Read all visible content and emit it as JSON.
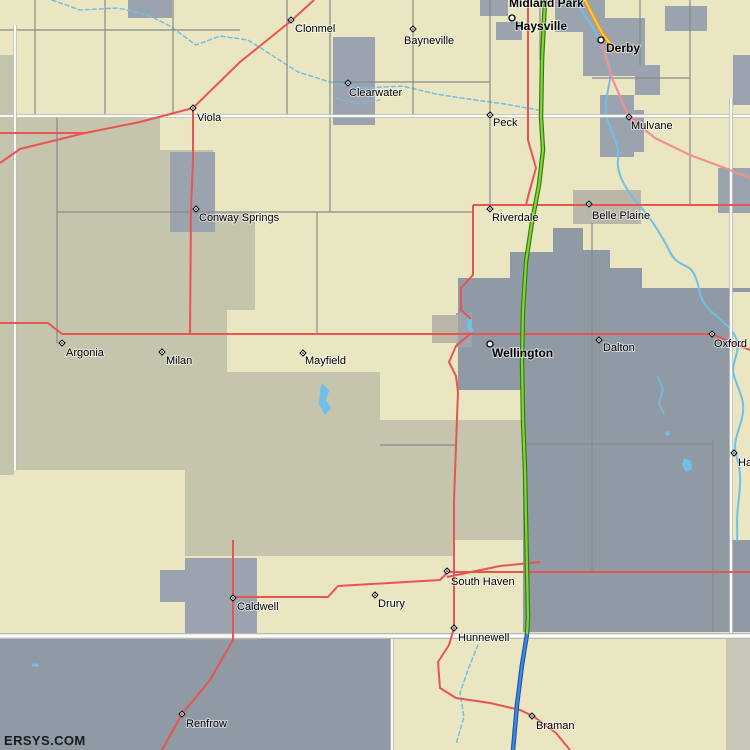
{
  "watermark": "ERSYS.COM",
  "map": {
    "width": 750,
    "height": 750,
    "palette": {
      "land_beige": "#e9e6c1",
      "land_sage": "#c5c4ac",
      "land_bluegray": "#8f9aa5",
      "urban_gray": "#9aa3ae",
      "urban_tan": "#bab7a9",
      "strip_gray": "#c9c8b8",
      "water": "#6fc0e8",
      "road_gray": "#8a8a8a",
      "road_white": "#f8f8f6",
      "road_white_casing": "#c0c0bb",
      "road_red": "#ea5450",
      "road_pink": "#f09090",
      "stateline_core": "#fcfcfa",
      "stateline_casing": "#b9b9b4",
      "turnpike_green_core": "#86d435",
      "turnpike_green_casing": "#2e7d0f",
      "interstate_blue_core": "#4189de",
      "interstate_blue_casing": "#1956a8",
      "route_orange_core": "#ffd23d",
      "route_orange_casing": "#f29422",
      "label_color": "#000000"
    },
    "regions": [
      {
        "name": "base-land",
        "fill": "land_beige",
        "type": "rect",
        "x": 0,
        "y": 0,
        "w": 750,
        "h": 750
      },
      {
        "name": "sage-left-edge-strip",
        "fill": "land_sage",
        "type": "rect",
        "x": 0,
        "y": 55,
        "w": 14,
        "h": 420
      },
      {
        "name": "sage-main-region",
        "fill": "land_sage",
        "type": "poly",
        "pts": "0,118 160,118 160,150 213,150 213,212 255,212 255,310 227,310 227,372 380,372 380,420 523,420 523,540 455,540 455,556 185,556 185,470 0,470"
      },
      {
        "name": "bluegray-main-region",
        "fill": "land_bluegray",
        "type": "poly",
        "pts": "458,278 510,278 510,252 553,252 553,228 583,228 583,250 610,250 610,268 642,268 642,288 750,288 750,632 523,632 523,390 458,390"
      },
      {
        "name": "beige-right-strip",
        "fill": "land_beige",
        "type": "rect",
        "x": 731,
        "y": 292,
        "w": 19,
        "h": 248
      },
      {
        "name": "oklahoma-bluegray-region",
        "fill": "land_bluegray",
        "type": "rect",
        "x": 0,
        "y": 637,
        "w": 393,
        "h": 113
      },
      {
        "name": "bottom-right-strip",
        "fill": "strip_gray",
        "type": "rect",
        "x": 726,
        "y": 637,
        "w": 24,
        "h": 113
      },
      {
        "name": "urban-haysville",
        "fill": "urban_gray",
        "type": "rect",
        "x": 555,
        "y": 0,
        "w": 50,
        "h": 32
      },
      {
        "name": "urban-haysville-west",
        "fill": "urban_gray",
        "type": "rect",
        "x": 480,
        "y": 0,
        "w": 28,
        "h": 16
      },
      {
        "name": "urban-haysville-south",
        "fill": "urban_gray",
        "type": "rect",
        "x": 496,
        "y": 22,
        "w": 26,
        "h": 18
      },
      {
        "name": "urban-derby",
        "fill": "urban_gray",
        "type": "rect",
        "x": 583,
        "y": 18,
        "w": 62,
        "h": 58
      },
      {
        "name": "urban-derby-east",
        "fill": "urban_gray",
        "type": "rect",
        "x": 665,
        "y": 6,
        "w": 42,
        "h": 25
      },
      {
        "name": "urban-derby-south",
        "fill": "urban_gray",
        "type": "rect",
        "x": 635,
        "y": 65,
        "w": 25,
        "h": 30
      },
      {
        "name": "urban-mulvane",
        "fill": "urban_gray",
        "type": "rect",
        "x": 600,
        "y": 95,
        "w": 34,
        "h": 62
      },
      {
        "name": "urban-mulvane-east",
        "fill": "urban_gray",
        "type": "rect",
        "x": 620,
        "y": 110,
        "w": 24,
        "h": 42
      },
      {
        "name": "urban-topleft",
        "fill": "urban_gray",
        "type": "rect",
        "x": 128,
        "y": 0,
        "w": 44,
        "h": 18
      },
      {
        "name": "urban-clearwater",
        "fill": "urban_gray",
        "type": "rect",
        "x": 333,
        "y": 37,
        "w": 42,
        "h": 88
      },
      {
        "name": "urban-conway-springs",
        "fill": "urban_gray",
        "type": "rect",
        "x": 170,
        "y": 152,
        "w": 45,
        "h": 80
      },
      {
        "name": "urban-right-edge-north",
        "fill": "urban_gray",
        "type": "rect",
        "x": 733,
        "y": 55,
        "w": 17,
        "h": 50
      },
      {
        "name": "urban-udall-corner",
        "fill": "urban_gray",
        "type": "rect",
        "x": 718,
        "y": 168,
        "w": 32,
        "h": 45
      },
      {
        "name": "urban-caldwell",
        "fill": "urban_gray",
        "type": "rect",
        "x": 185,
        "y": 558,
        "w": 72,
        "h": 82
      },
      {
        "name": "urban-caldwell-west",
        "fill": "urban_gray",
        "type": "rect",
        "x": 160,
        "y": 570,
        "w": 25,
        "h": 32
      },
      {
        "name": "urban-wellington-junction",
        "fill": "urban_gray",
        "type": "rect",
        "x": 456,
        "y": 313,
        "w": 16,
        "h": 34
      },
      {
        "name": "urban-belle-plaine",
        "fill": "urban_tan",
        "type": "rect",
        "x": 573,
        "y": 190,
        "w": 68,
        "h": 34
      },
      {
        "name": "urban-junction-tan",
        "fill": "urban_tan",
        "type": "rect",
        "x": 432,
        "y": 315,
        "w": 26,
        "h": 28
      }
    ],
    "waterways": [
      {
        "name": "arkansas-river",
        "dashed": false,
        "width": 2,
        "d": "M575,0 C582,14 593,24 598,38 C604,52 612,64 610,80 C607,96 604,104 607,118 C611,132 620,146 618,160 C616,174 626,190 640,206 C652,220 662,236 670,252 C678,268 688,262 694,274 C700,284 698,296 706,306 C716,318 730,324 736,338 C742,352 730,362 734,376 C740,394 746,402 742,418 C738,434 732,442 737,458 C742,474 740,490 738,506 C736,522 738,530 737,540"
      },
      {
        "name": "ninnescah-stream",
        "dashed": true,
        "width": 1.5,
        "d": "M52,0 L80,10 L118,8 L148,15 L170,26 L196,45 L220,36 L248,40 L270,54 L298,72 L330,82 L366,88 L402,86 L436,94 L468,99 L505,104 L538,110"
      },
      {
        "name": "clearwater-creek",
        "dashed": true,
        "width": 1.2,
        "d": "M336,98 L358,104 L380,100"
      },
      {
        "name": "hunnewell-creek",
        "dashed": true,
        "width": 1.5,
        "d": "M478,645 L469,667 L460,693 L464,717 L456,744"
      },
      {
        "name": "slate-creek",
        "dashed": false,
        "width": 1.5,
        "d": "M658,377 L663,390 L659,403 L664,414"
      }
    ],
    "waterbodies": [
      {
        "name": "mayfield-lake",
        "d": "M322,383 L329,391 L326,400 L331,408 L325,415 L319,404 L320,391 Z"
      },
      {
        "name": "wellington-pond",
        "d": "M468,318 l4,2 l-1,6 l3,5 l-4,2 l-3,-6 Z"
      },
      {
        "name": "small-lake-east",
        "d": "M684,458 l7,3 l1,8 l-6,3 l-4,-7 Z"
      },
      {
        "name": "small-pond-east",
        "d": "M666,431 l4,1 l-1,4 l-4,-1 Z"
      },
      {
        "name": "small-pond-ok",
        "d": "M33,663 l6,1 l-1,3 l-6,-1 Z"
      }
    ],
    "roads_gray": [
      "M0,30 H240",
      "M35,0 V117",
      "M105,0 V117",
      "M173,0 V117",
      "M287,0 V117",
      "M330,0 V212",
      "M413,0 V117",
      "M490,0 V209",
      "M540,0 V60",
      "M640,0 V65",
      "M690,0 V205",
      "M333,82 H490",
      "M592,78 H690",
      "M57,212 H473",
      "M57,117 V343",
      "M317,212 V335",
      "M592,223 V571",
      "M713,440 V632",
      "M527,444 H713",
      "M380,445 H457"
    ],
    "roads_white": [
      "M0,116 H750",
      "M15,25 V470",
      "M731,98 V635",
      "M392,635 V750"
    ],
    "stateline": "M0,636 H750",
    "roads_red": [
      "M314,0 L291,21 L240,62 L193,108 L140,122 L85,133 L20,149 L0,163",
      "M0,133 H85",
      "M193,108 L193,160 L191,209 L190,334",
      "M0,323 L48,323 L62,334 L712,334 L728,341 L750,350",
      "M528,0 V140 L536,168 L529,193 L526,205",
      "M473,205 H750",
      "M473,205 L473,275 L461,288 L461,310 L470,318 L470,334 L456,346 L449,362 L456,376 L458,392 L454,500 L454,628 L449,645 L438,662 L440,688 L456,698 L490,703 L520,710 L533,716 L556,733 L570,750",
      "M447,572 H750",
      "M233,540 V640 L210,680 L182,714 L162,750",
      "M233,597 H328 L338,586 L440,580 L447,573",
      "M447,577 L500,566 L540,562"
    ],
    "roads_pink": [
      "M601,40 L612,78 L629,117 L655,138 L690,155 L722,167 L750,178"
    ],
    "highways": [
      {
        "name": "route-orange",
        "casing": "route_orange_casing",
        "core": "route_orange_core",
        "cw": 4,
        "w": 1.8,
        "d": "M585,0 L593,16 L602,33 L612,46 L618,53"
      },
      {
        "name": "kansas-turnpike-green",
        "casing": "turnpike_green_casing",
        "core": "turnpike_green_core",
        "cw": 4.5,
        "w": 2.2,
        "d": "M545,0 L542,60 L541,117 L543,150 L539,185 L532,222 L526,262 L523,310 L522,360 L523,420 L525,470 L526,520 L527,570 L528,617 L527,634"
      },
      {
        "name": "interstate-blue",
        "casing": "interstate_blue_casing",
        "core": "interstate_blue_core",
        "cw": 4.5,
        "w": 2.2,
        "d": "M527,634 L522,665 L517,705 L513,750"
      }
    ],
    "cities": [
      {
        "label": "Midland Park",
        "lx": 509,
        "ly": 7,
        "marker": "none",
        "bold": true
      },
      {
        "label": "Haysville",
        "lx": 515,
        "ly": 30,
        "marker": "circle",
        "mx": 512,
        "my": 18,
        "bold": true
      },
      {
        "label": "Derby",
        "lx": 606,
        "ly": 52,
        "marker": "circle",
        "mx": 601,
        "my": 40,
        "bold": true
      },
      {
        "label": "Clonmel",
        "lx": 295,
        "ly": 32,
        "marker": "diamond",
        "mx": 291,
        "my": 20,
        "bold": false
      },
      {
        "label": "Bayneville",
        "lx": 404,
        "ly": 44,
        "marker": "diamond",
        "mx": 413,
        "my": 29,
        "bold": false
      },
      {
        "label": "Clearwater",
        "lx": 349,
        "ly": 96,
        "marker": "diamond",
        "mx": 348,
        "my": 83,
        "bold": false
      },
      {
        "label": "Viola",
        "lx": 197,
        "ly": 121,
        "marker": "diamond",
        "mx": 193,
        "my": 108,
        "bold": false
      },
      {
        "label": "Peck",
        "lx": 493,
        "ly": 126,
        "marker": "diamond",
        "mx": 490,
        "my": 115,
        "bold": false
      },
      {
        "label": "Mulvane",
        "lx": 631,
        "ly": 129,
        "marker": "diamond",
        "mx": 629,
        "my": 117,
        "bold": false
      },
      {
        "label": "Conway Springs",
        "lx": 199,
        "ly": 221,
        "marker": "diamond",
        "mx": 196,
        "my": 209,
        "bold": false
      },
      {
        "label": "Riverdale",
        "lx": 492,
        "ly": 221,
        "marker": "diamond",
        "mx": 490,
        "my": 209,
        "bold": false
      },
      {
        "label": "Belle Plaine",
        "lx": 592,
        "ly": 219,
        "marker": "diamond",
        "mx": 589,
        "my": 204,
        "bold": false
      },
      {
        "label": "Wellington",
        "lx": 492,
        "ly": 357,
        "marker": "circle",
        "mx": 490,
        "my": 344,
        "bold": true
      },
      {
        "label": "Dalton",
        "lx": 603,
        "ly": 351,
        "marker": "diamond",
        "mx": 599,
        "my": 340,
        "bold": false
      },
      {
        "label": "Oxford",
        "lx": 714,
        "ly": 347,
        "marker": "diamond",
        "mx": 712,
        "my": 334,
        "bold": false
      },
      {
        "label": "Argonia",
        "lx": 66,
        "ly": 356,
        "marker": "diamond",
        "mx": 62,
        "my": 343,
        "bold": false
      },
      {
        "label": "Milan",
        "lx": 166,
        "ly": 364,
        "marker": "diamond",
        "mx": 162,
        "my": 352,
        "bold": false
      },
      {
        "label": "Mayfield",
        "lx": 305,
        "ly": 364,
        "marker": "diamond",
        "mx": 303,
        "my": 353,
        "bold": false
      },
      {
        "label": "Caldwell",
        "lx": 237,
        "ly": 610,
        "marker": "diamond",
        "mx": 233,
        "my": 598,
        "bold": false
      },
      {
        "label": "Drury",
        "lx": 378,
        "ly": 607,
        "marker": "diamond",
        "mx": 375,
        "my": 595,
        "bold": false
      },
      {
        "label": "South Haven",
        "lx": 451,
        "ly": 585,
        "marker": "diamond",
        "mx": 447,
        "my": 571,
        "bold": false
      },
      {
        "label": "Hunnewell",
        "lx": 458,
        "ly": 641,
        "marker": "diamond",
        "mx": 454,
        "my": 628,
        "bold": false
      },
      {
        "label": "Renfrow",
        "lx": 186,
        "ly": 727,
        "marker": "diamond",
        "mx": 182,
        "my": 714,
        "bold": false
      },
      {
        "label": "Braman",
        "lx": 536,
        "ly": 729,
        "marker": "diamond",
        "mx": 532,
        "my": 716,
        "bold": false
      },
      {
        "label": "Ha",
        "lx": 738,
        "ly": 466,
        "marker": "diamond",
        "mx": 734,
        "my": 453,
        "bold": false
      }
    ]
  }
}
